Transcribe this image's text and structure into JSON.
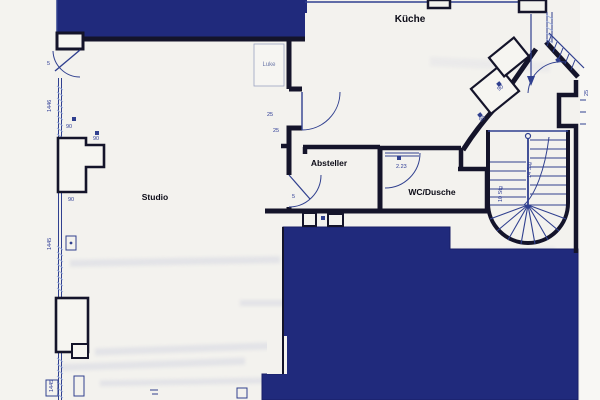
{
  "rooms": {
    "kitchen": "Küche",
    "studio": "Studio",
    "storage": "Absteller",
    "bath": "WC/Dusche",
    "hatch": "Luke"
  },
  "stair_labels": {
    "right_flight": "14 Stg",
    "left_flight": "10 Stg"
  },
  "dims": {
    "left_top": "1446",
    "left_mid": "1445",
    "left_bottom": "1445",
    "pillar_top": "90",
    "pillar_right": "90",
    "pillar_bottom": "90",
    "door_top_left": "5",
    "kitchen_door_a": "25",
    "kitchen_door_b": "25",
    "storage_door": "5",
    "bath_door": "2.23",
    "landing_a": "90",
    "landing_b": "90",
    "right_edge": "25"
  },
  "colors": {
    "navy_fill": "#202a7c",
    "wall_ink": "#14142a",
    "line_blue": "#30408f",
    "hatch_blue": "#9fb0dc",
    "paper": "#f3f2ee"
  }
}
